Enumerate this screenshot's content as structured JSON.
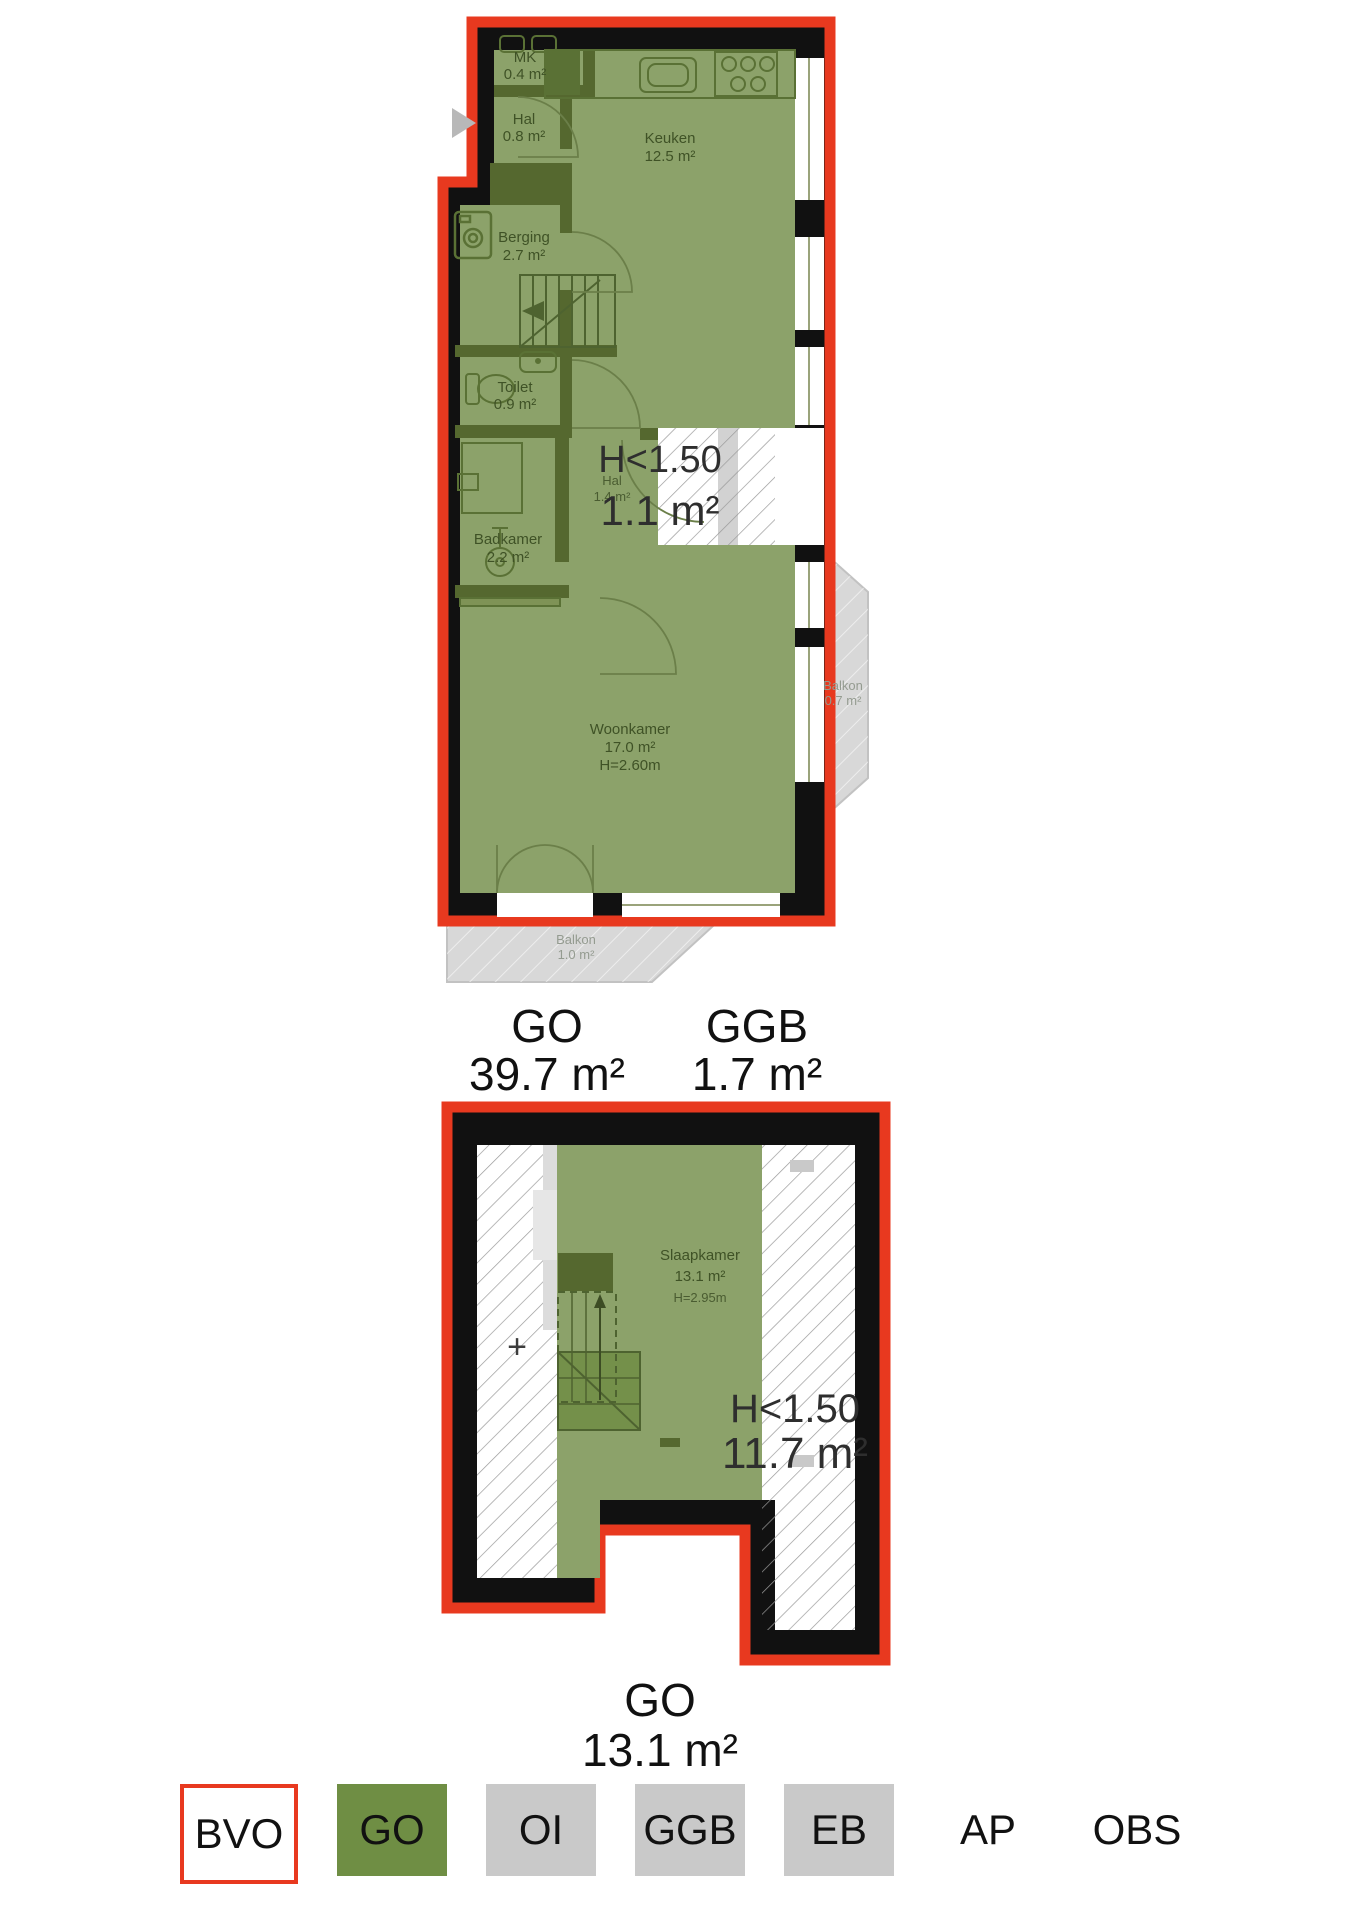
{
  "floor1": {
    "rooms": {
      "mk": {
        "name": "MK",
        "area": "0.4 m²"
      },
      "hal": {
        "name": "Hal",
        "area": "0.8 m²"
      },
      "keuken": {
        "name": "Keuken",
        "area": "12.5 m²"
      },
      "berging": {
        "name": "Berging",
        "area": "2.7 m²"
      },
      "toilet": {
        "name": "Toilet",
        "area": "0.9 m²"
      },
      "hal2": {
        "name": "Hal",
        "area": "1.4 m²"
      },
      "badkamer": {
        "name": "Badkamer",
        "area": "2.2 m²"
      },
      "woonkamer": {
        "name": "Woonkamer",
        "area": "17.0 m²",
        "height": "H=2.60m"
      },
      "balkon_zij": {
        "name": "Balkon",
        "area": "0.7 m²"
      },
      "balkon_onder": {
        "name": "Balkon",
        "area": "1.0 m²"
      }
    },
    "low_height": {
      "label": "H<1.50",
      "area": "1.1 m²"
    },
    "totals": {
      "go_label": "GO",
      "go_area": "39.7 m²",
      "ggb_label": "GGB",
      "ggb_area": "1.7 m²"
    }
  },
  "floor2": {
    "rooms": {
      "slaapkamer": {
        "name": "Slaapkamer",
        "area": "13.1 m²",
        "height": "H=2.95m"
      }
    },
    "low_height": {
      "label": "H<1.50",
      "area": "11.7 m²"
    },
    "plus_marker": "+",
    "totals": {
      "go_label": "GO",
      "go_area": "13.1 m²"
    }
  },
  "legend": {
    "items": [
      {
        "label": "BVO",
        "style": "bvo"
      },
      {
        "label": "GO",
        "style": "go"
      },
      {
        "label": "OI",
        "style": "gray"
      },
      {
        "label": "GGB",
        "style": "gray"
      },
      {
        "label": "EB",
        "style": "gray"
      },
      {
        "label": "AP",
        "style": "plain"
      },
      {
        "label": "OBS",
        "style": "plain"
      }
    ]
  },
  "colors": {
    "bvo_red": "#e8391f",
    "go_green": "#6f8e44",
    "legend_gray": "#c9c9c9",
    "plan_fill": "#8ca26a",
    "wall_dark": "#55682f",
    "wall_black": "#111111",
    "balkon_gray": "#d8d8d8"
  }
}
